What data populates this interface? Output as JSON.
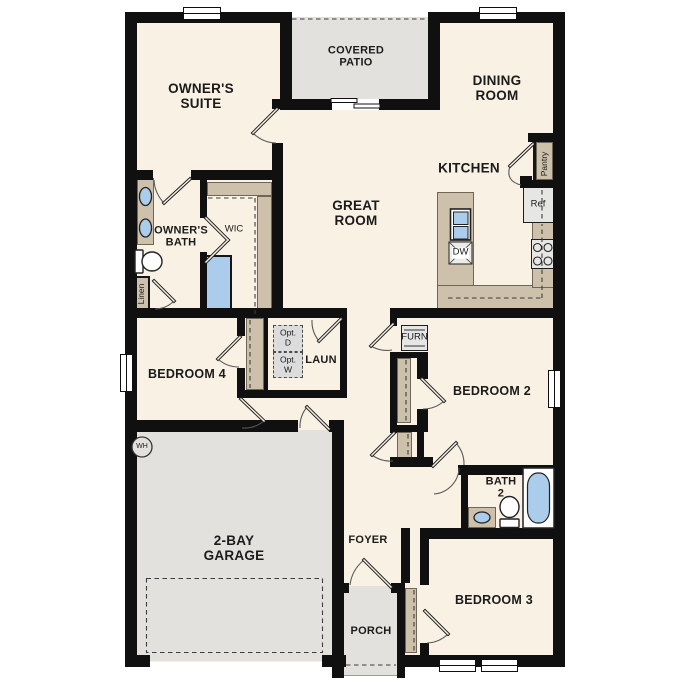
{
  "labels": {
    "owners_suite": "OWNER'S\nSUITE",
    "covered_patio": "COVERED\nPATIO",
    "dining_room": "DINING\nROOM",
    "kitchen": "KITCHEN",
    "great_room": "GREAT\nROOM",
    "owners_bath": "OWNER'S\nBATH",
    "wic": "WIC",
    "laundry": "LAUN",
    "opt_d": "Opt.\nD",
    "opt_w": "Opt.\nW",
    "bedroom4": "BEDROOM 4",
    "bedroom2": "BEDROOM 2",
    "bedroom3": "BEDROOM 3",
    "garage": "2-BAY\nGARAGE",
    "foyer": "FOYER",
    "porch": "PORCH",
    "bath2": "BATH\n2",
    "pantry": "Pantry",
    "ref": "Ref",
    "dw": "DW",
    "furn": "FURN",
    "linen": "Linen",
    "wh": "WH"
  },
  "theme": {
    "floor": "#f8f1e4",
    "hardscape": "#e2e1dd",
    "cabinet": "#cdc1ab",
    "fixture_blue": "#abccea",
    "wall": "#101010",
    "appliance": "#e6e6e4",
    "text": "#1b1b1b"
  }
}
